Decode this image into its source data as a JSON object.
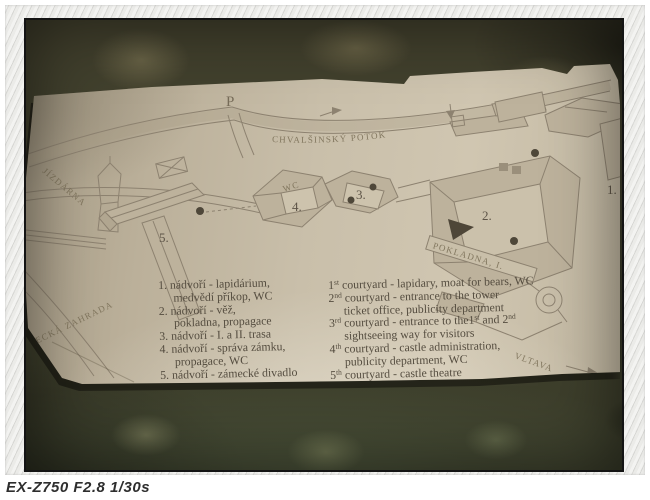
{
  "caption": {
    "text": "EX-Z750 F2.8 1/30s"
  },
  "map": {
    "parking": "P",
    "stream": "CHVALŠINSKÝ POTOK",
    "riding_hall": "JÍZDÁRNA",
    "garden": "ZÁMECKÁ ZAHRADA",
    "river": "VLTAVA",
    "ticket_office": "POKLADNA, I.",
    "wc": "WC",
    "n1": "1.",
    "n2": "2.",
    "n3": "3.",
    "n4": "4.",
    "n5": "5."
  },
  "legend_cz": {
    "items": [
      {
        "num": "1.",
        "text": " nádvoří - lapidárium,"
      },
      {
        "cont": "medvědí příkop, WC"
      },
      {
        "num": "2.",
        "text": " nádvoří - věž,"
      },
      {
        "cont": "pokladna, propagace"
      },
      {
        "num": "3.",
        "text": " nádvoří - I. a II. trasa"
      },
      {
        "num": "4.",
        "text": " nádvoří - správa zámku,"
      },
      {
        "cont": "propagace, WC"
      },
      {
        "num": "5.",
        "text": " nádvoří - zámecké divadlo"
      }
    ]
  },
  "legend_en": {
    "items": [
      {
        "ord": "1",
        "sup": "st",
        "text": " courtyard - lapidary, moat for bears, WC"
      },
      {
        "ord": "2",
        "sup": "nd",
        "text": " courtyard - entrance to the tower"
      },
      {
        "cont": "ticket office, publicity department"
      },
      {
        "ord": "3",
        "sup": "rd",
        "text": " courtyard - entrance to the1",
        "sup2": "st",
        "text2": " and 2",
        "sup3": "nd"
      },
      {
        "cont": "sightseeing way for visitors"
      },
      {
        "ord": "4",
        "sup": "th",
        "text": " courtyard - castle administration,"
      },
      {
        "cont": "publicity department, WC"
      },
      {
        "ord": "5",
        "sup": "th",
        "text": " courtyard - castle theatre"
      }
    ]
  },
  "colors": {
    "paper": "#c7bda8",
    "map_ink": "#8d8270",
    "carpet": "#3f3c2b",
    "frame": "#e9e9e7"
  }
}
